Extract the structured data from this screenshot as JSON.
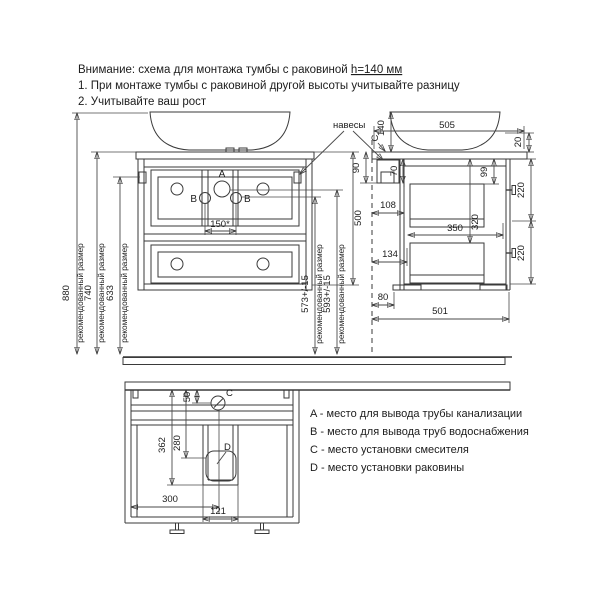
{
  "header": {
    "title_main": "Внимание: схема для монтажа тумбы с раковиной ",
    "title_height": "h=140 мм",
    "note1": "1. При монтаже тумбы с раковиной другой высоты учитывайте разницу",
    "note2": "2. Учитывайте ваш рост"
  },
  "front_view": {
    "point_a": "A",
    "point_b_left": "B",
    "point_b_right": "B",
    "hangers_label": "навесы",
    "dims": {
      "total_height": "880",
      "counter_height": "740",
      "hanger_height": "633",
      "note": "рекомендованный размер",
      "supply_height": "573+/-15",
      "drain_height": "593+/-15",
      "cabinet_height": "500",
      "pipe_spacing": "150*"
    }
  },
  "side_view": {
    "point_c": "С",
    "point_d": "D",
    "dims": {
      "sink_height": "140",
      "counter_depth": "505",
      "top_gap": "20",
      "hanger_mount": "90",
      "hanger_body": "70",
      "hanger_depth": "108",
      "drawer_top_inset": "99",
      "drawer_front_upper": "220",
      "drawer_front_lower": "220",
      "inner_height": "320",
      "drawer_depth": "350",
      "back_clearance": "134",
      "foot_inset": "80",
      "cabinet_depth": "501"
    }
  },
  "plan_view": {
    "point_c": "С",
    "point_d": "D",
    "dims": {
      "faucet_offset": "50",
      "drain_far": "362",
      "drain_center": "280",
      "center_offset": "300",
      "recess_width": "121"
    }
  },
  "legend": {
    "items": [
      "A - место для вывода трубы канализации",
      "B - место для вывода труб водоснабжения",
      "C - место установки смесителя",
      "D - место установки раковины"
    ]
  },
  "colors": {
    "drain_point": "#2eb52e",
    "supply_point": "#2026d6"
  }
}
